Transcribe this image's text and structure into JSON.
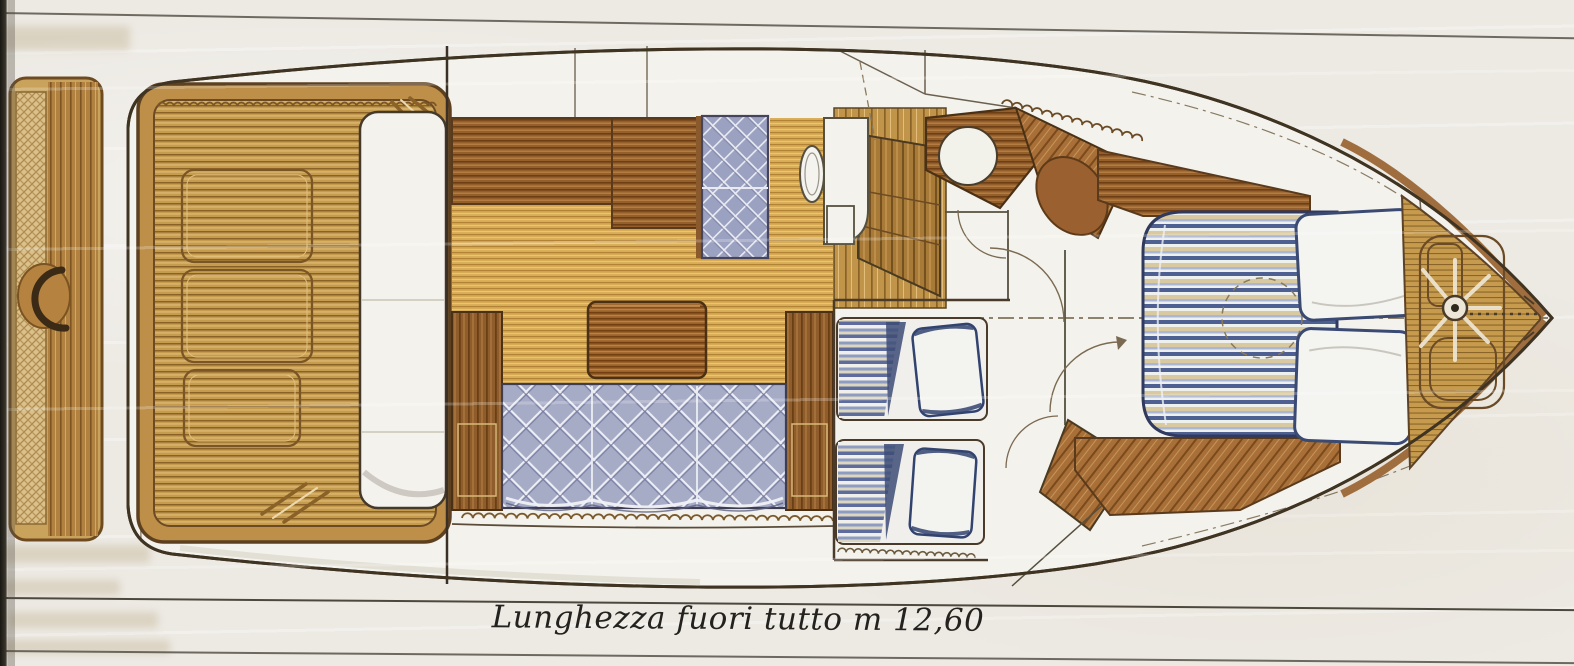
{
  "caption": {
    "text": "Lunghezza fuori tutto m 12,60"
  },
  "palette": {
    "paper": "#edeae4",
    "hull_outline": "#3f3322",
    "deck_white": "#f4f2ec",
    "teak_gold": "#c79b4e",
    "wood_dark": "#8f5c2b",
    "upholstery_blue": "#a6abc6",
    "mattress_navy": "#4e5f92",
    "gunwale_brown": "#a06e3e",
    "rule_line": "#4c483e"
  }
}
